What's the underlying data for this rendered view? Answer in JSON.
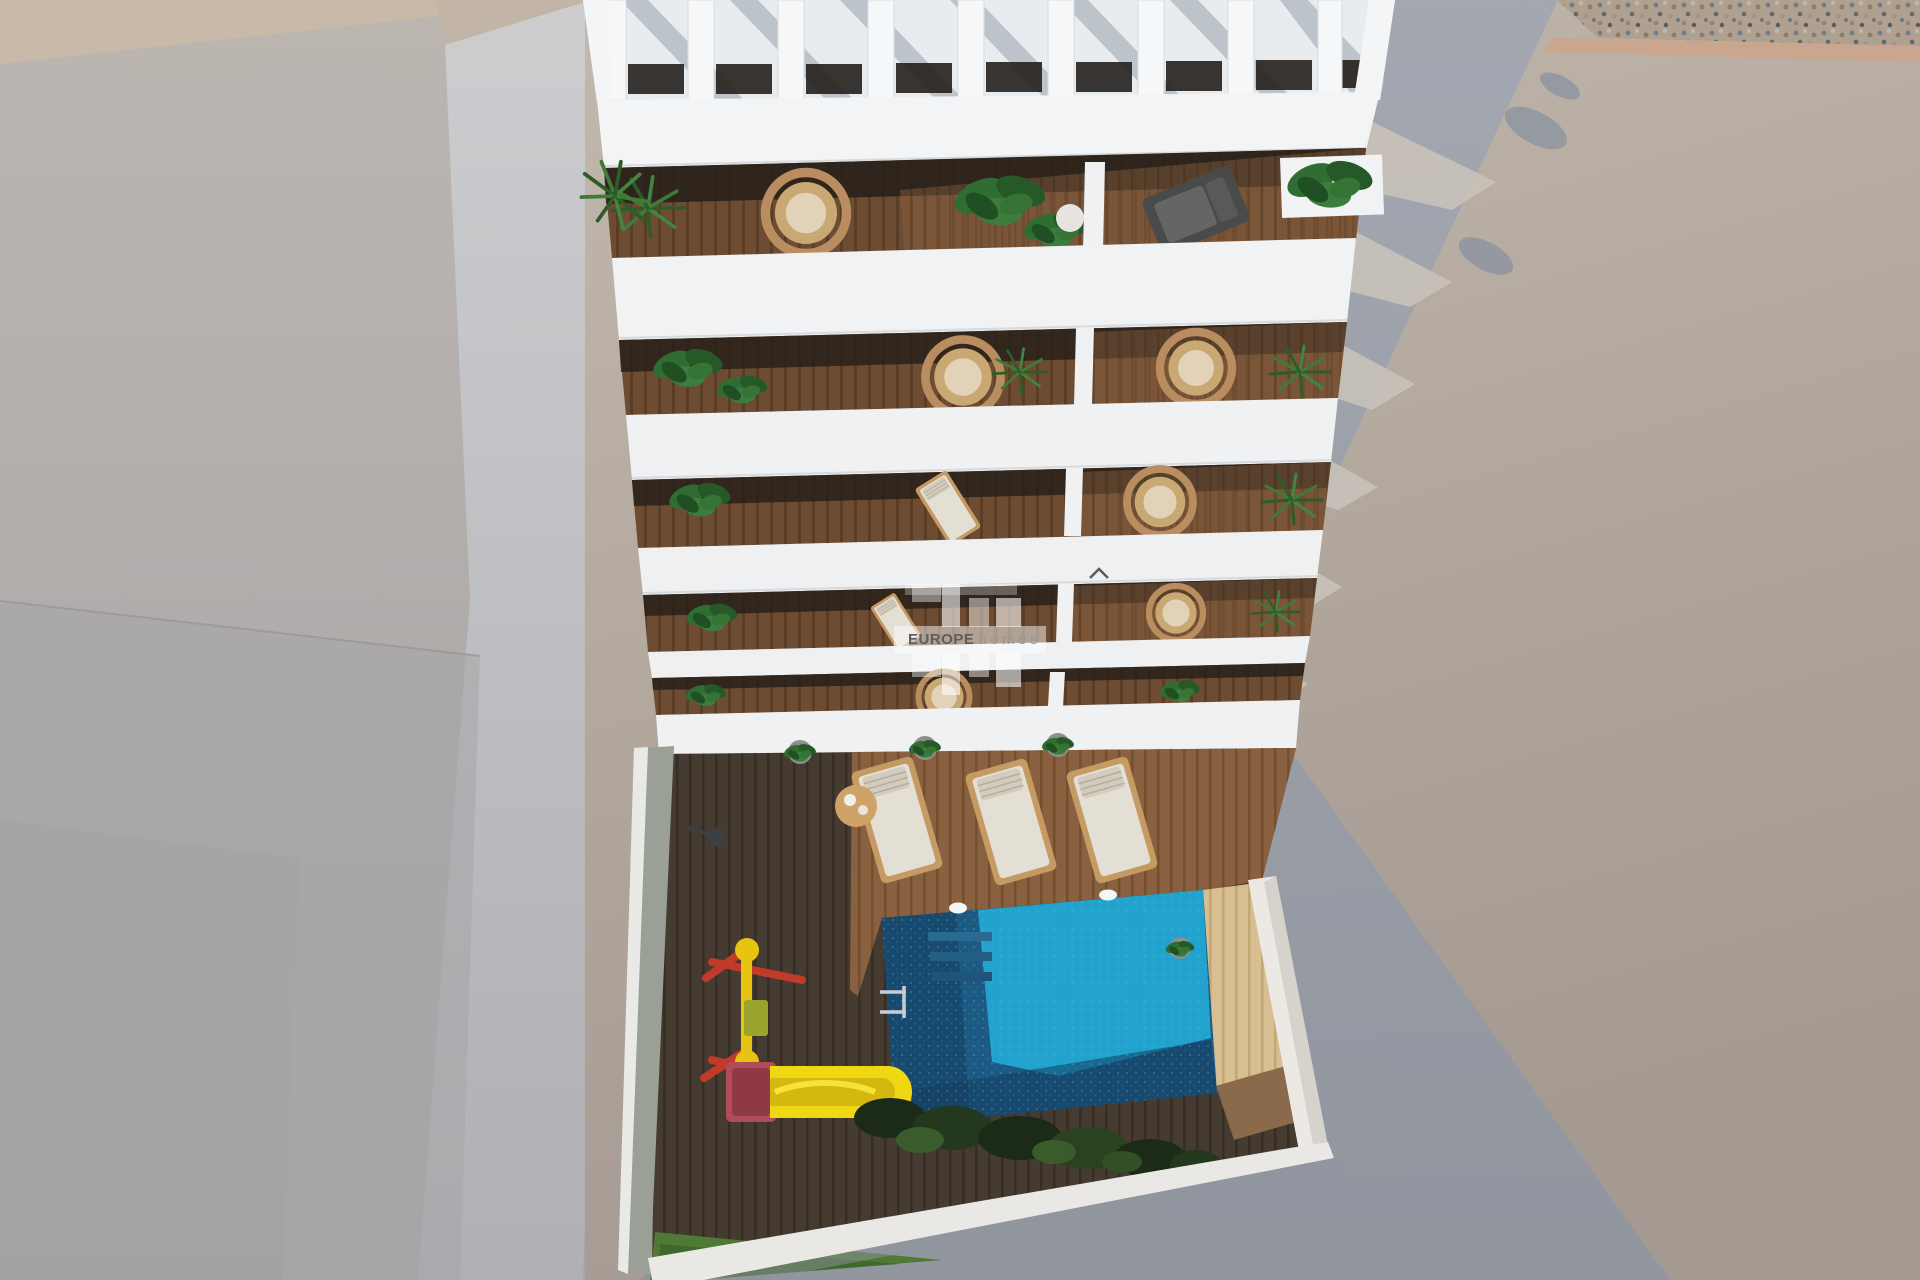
{
  "image_type": "3d-architectural-render",
  "view": "aerial-top-down",
  "watermark": {
    "logo": "EH",
    "brand": "EUROPE",
    "brand_sub": "homes"
  },
  "scene": {
    "building": {
      "description": "white apartment block with rooftop pergola and five balcony floors",
      "balcony_floors": 5,
      "balcony_contents": [
        "wood deck",
        "wicker chairs",
        "green plants",
        "lounge chair",
        "white dividers"
      ]
    },
    "courtyard": {
      "description": "sunken patio with wooden deck",
      "pool": {
        "color_sunlit": "#21a3cd",
        "color_shadow": "#1a4e74",
        "lights": 2,
        "ladder": 1
      },
      "sun_loungers": 3,
      "side_table": 1,
      "potted_plants": 3,
      "playground": {
        "slide_color": "#f0d713",
        "platform_color": "#b04b58",
        "frame_colors": [
          "#c23a2a",
          "#e8c412"
        ]
      },
      "hedge": "dark green bushes",
      "grass_patch": "bottom left"
    },
    "surroundings": {
      "plaza_sunlit": "#b3a79c",
      "plaza_shadow": "#999ea9",
      "gravel_strip": "top-right corner",
      "building_shadow_direction": "cast to the right"
    }
  },
  "palette": {
    "building_white": "#f2f3f5",
    "deck_dark": "#463b31",
    "deck_sunlit": "#8a6140",
    "deck_pale": "#d8bf92",
    "plant_green": "#2f6d33",
    "pool_bright": "#21a3cd",
    "pool_dark": "#1a4e74",
    "slide_yellow": "#f0d713",
    "platform_red": "#b04b58"
  }
}
